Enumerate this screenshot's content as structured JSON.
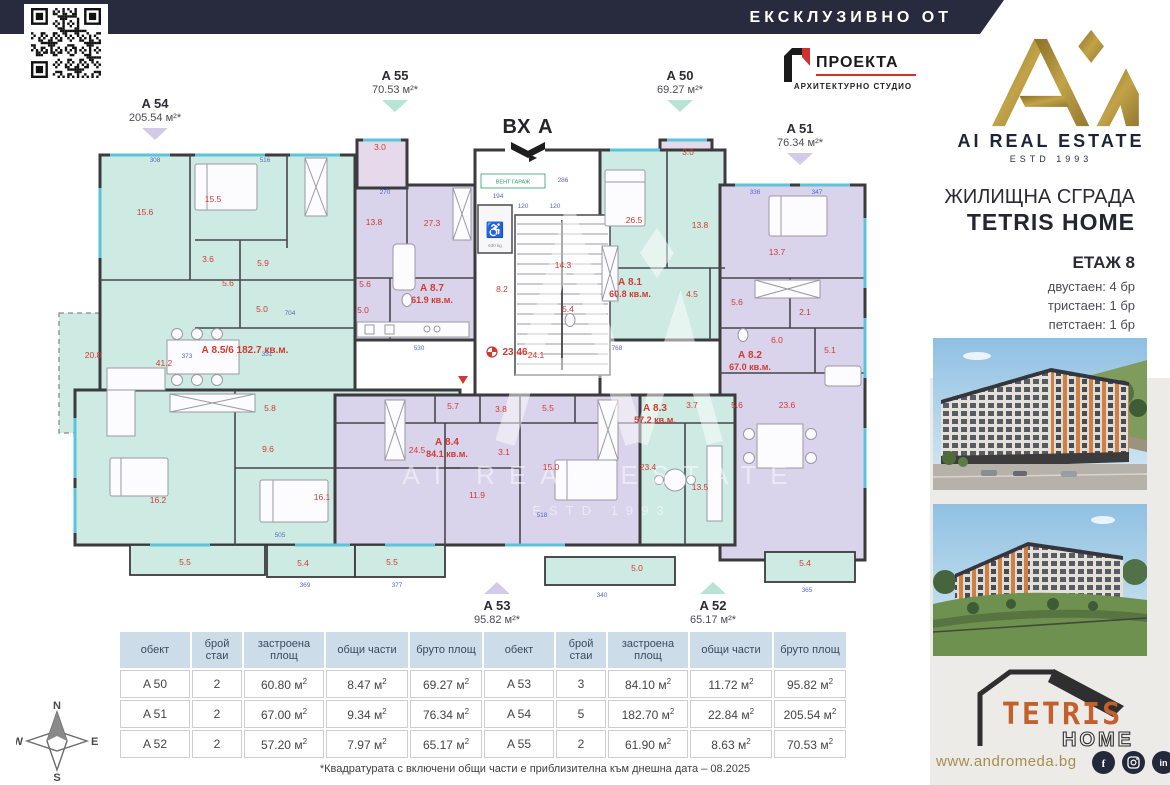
{
  "banner": {
    "label": "ЕКСКЛУЗИВНО ОТ"
  },
  "brand": {
    "name": "AI REAL ESTATE",
    "estd": "ESTD 1993"
  },
  "architect": {
    "name": "ПРОЕКТА",
    "subtitle": "АРХИТЕКТУРНО СТУДИО"
  },
  "building": {
    "type_label": "ЖИЛИЩНА СГРАДА",
    "name": "TETRIS HOME",
    "floor": "ЕТАЖ 8",
    "units": [
      "двустаен: 4 бр",
      "тристаен: 1 бр",
      "петстаен: 1 бр"
    ]
  },
  "entrance": {
    "label": "ВХ А"
  },
  "plan": {
    "callouts": [
      {
        "id": "A 54",
        "area": "205.54 м²*",
        "x": 155,
        "y": 96,
        "dir": "down",
        "tone": "lavender"
      },
      {
        "id": "A 55",
        "area": "70.53 м²*",
        "x": 395,
        "y": 68,
        "dir": "down",
        "tone": "mint"
      },
      {
        "id": "A 50",
        "area": "69.27 м²*",
        "x": 680,
        "y": 68,
        "dir": "down",
        "tone": "mint"
      },
      {
        "id": "A 51",
        "area": "76.34 м²*",
        "x": 800,
        "y": 121,
        "dir": "down",
        "tone": "lavender"
      },
      {
        "id": "A 53",
        "area": "95.82 м²*",
        "x": 497,
        "y": 582,
        "dir": "up",
        "tone": "lavender"
      },
      {
        "id": "A 52",
        "area": "65.17 м²*",
        "x": 713,
        "y": 582,
        "dir": "up",
        "tone": "mint"
      }
    ],
    "units": [
      {
        "id": "А 8.7",
        "area": "61.9 кв.м.",
        "x": 377,
        "y": 163
      },
      {
        "id": "А 8.1",
        "area": "60.8 кв.м.",
        "x": 575,
        "y": 157
      },
      {
        "id": "А 8.5/6",
        "area": "182.7 кв.м.",
        "x": 190,
        "y": 225,
        "inline": true
      },
      {
        "id": "А 8.2",
        "area": "67.0 кв.м.",
        "x": 695,
        "y": 230
      },
      {
        "id": "А 8.3",
        "area": "57.2 кв.м.",
        "x": 600,
        "y": 283
      },
      {
        "id": "А 8.4",
        "area": "84.1 кв.м.",
        "x": 392,
        "y": 317
      }
    ],
    "rooms": [
      {
        "t": "15.6",
        "x": 90,
        "y": 87
      },
      {
        "t": "15.5",
        "x": 158,
        "y": 74
      },
      {
        "t": "3.6",
        "x": 153,
        "y": 134
      },
      {
        "t": "5.9",
        "x": 208,
        "y": 138
      },
      {
        "t": "5.6",
        "x": 173,
        "y": 158
      },
      {
        "t": "5.0",
        "x": 207,
        "y": 184
      },
      {
        "t": "20.8",
        "x": 38,
        "y": 230
      },
      {
        "t": "41.2",
        "x": 109,
        "y": 238
      },
      {
        "t": "5.8",
        "x": 215,
        "y": 283
      },
      {
        "t": "9.6",
        "x": 213,
        "y": 324
      },
      {
        "t": "16.2",
        "x": 103,
        "y": 375
      },
      {
        "t": "16.1",
        "x": 267,
        "y": 372
      },
      {
        "t": "13.8",
        "x": 319,
        "y": 97
      },
      {
        "t": "27.3",
        "x": 377,
        "y": 98
      },
      {
        "t": "5.6",
        "x": 310,
        "y": 159
      },
      {
        "t": "5.0",
        "x": 308,
        "y": 185
      },
      {
        "t": "3.0",
        "x": 325,
        "y": 22
      },
      {
        "t": "3.0",
        "x": 633,
        "y": 27
      },
      {
        "t": "8.2",
        "x": 447,
        "y": 164
      },
      {
        "t": "14.3",
        "x": 508,
        "y": 140
      },
      {
        "t": "5.4",
        "x": 513,
        "y": 184
      },
      {
        "t": "24.1",
        "x": 481,
        "y": 230
      },
      {
        "t": "26.5",
        "x": 579,
        "y": 95
      },
      {
        "t": "13.8",
        "x": 645,
        "y": 100
      },
      {
        "t": "4.5",
        "x": 637,
        "y": 169
      },
      {
        "t": "5.6",
        "x": 682,
        "y": 177
      },
      {
        "t": "13.7",
        "x": 722,
        "y": 127
      },
      {
        "t": "2.1",
        "x": 750,
        "y": 187
      },
      {
        "t": "6.0",
        "x": 722,
        "y": 215
      },
      {
        "t": "5.1",
        "x": 775,
        "y": 225
      },
      {
        "t": "3.7",
        "x": 637,
        "y": 280
      },
      {
        "t": "5.6",
        "x": 682,
        "y": 280
      },
      {
        "t": "23.6",
        "x": 732,
        "y": 280
      },
      {
        "t": "23.4",
        "x": 593,
        "y": 342
      },
      {
        "t": "13.5",
        "x": 645,
        "y": 362
      },
      {
        "t": "5.7",
        "x": 398,
        "y": 281
      },
      {
        "t": "3.8",
        "x": 446,
        "y": 284
      },
      {
        "t": "5.5",
        "x": 493,
        "y": 283
      },
      {
        "t": "3.1",
        "x": 449,
        "y": 327
      },
      {
        "t": "24.5",
        "x": 362,
        "y": 325
      },
      {
        "t": "11.9",
        "x": 422,
        "y": 370
      },
      {
        "t": "15.0",
        "x": 496,
        "y": 342
      },
      {
        "t": "5.5",
        "x": 130,
        "y": 437
      },
      {
        "t": "5.4",
        "x": 248,
        "y": 438
      },
      {
        "t": "5.5",
        "x": 337,
        "y": 437
      },
      {
        "t": "5.0",
        "x": 582,
        "y": 443
      },
      {
        "t": "5.4",
        "x": 750,
        "y": 438
      }
    ],
    "dims": [
      {
        "t": "530",
        "x": 364,
        "y": 222
      },
      {
        "t": "768",
        "x": 562,
        "y": 222
      },
      {
        "t": "704",
        "x": 235,
        "y": 187
      },
      {
        "t": "373",
        "x": 132,
        "y": 230
      },
      {
        "t": "331",
        "x": 212,
        "y": 228
      },
      {
        "t": "286",
        "x": 508,
        "y": 54
      },
      {
        "t": "194",
        "x": 443,
        "y": 70
      },
      {
        "t": "120",
        "x": 468,
        "y": 80
      },
      {
        "t": "120",
        "x": 500,
        "y": 80
      },
      {
        "t": "377",
        "x": 342,
        "y": 459
      },
      {
        "t": "369",
        "x": 250,
        "y": 459
      },
      {
        "t": "340",
        "x": 547,
        "y": 469
      },
      {
        "t": "365",
        "x": 752,
        "y": 464
      },
      {
        "t": "505",
        "x": 225,
        "y": 409
      },
      {
        "t": "518",
        "x": 487,
        "y": 389
      },
      {
        "t": "308",
        "x": 100,
        "y": 34
      },
      {
        "t": "516",
        "x": 210,
        "y": 34
      },
      {
        "t": "336",
        "x": 700,
        "y": 66
      },
      {
        "t": "347",
        "x": 762,
        "y": 66
      },
      {
        "t": "270",
        "x": 330,
        "y": 66
      }
    ],
    "marks": {
      "total": "23.46",
      "vent": "ВЕНТ ГАРАЖ",
      "lift": "630 kg"
    }
  },
  "area_tables": {
    "headers": [
      "обект",
      "брой стаи",
      "застроена площ",
      "общи части",
      "бруто площ"
    ],
    "tables": [
      [
        [
          "A 50",
          "2",
          "60.80",
          "8.47",
          "69.27"
        ],
        [
          "A 51",
          "2",
          "67.00",
          "9.34",
          "76.34"
        ],
        [
          "A 52",
          "2",
          "57.20",
          "7.97",
          "65.17"
        ]
      ],
      [
        [
          "A 53",
          "3",
          "84.10",
          "11.72",
          "95.82"
        ],
        [
          "A 54",
          "5",
          "182.70",
          "22.84",
          "205.54"
        ],
        [
          "A 55",
          "2",
          "61.90",
          "8.63",
          "70.53"
        ]
      ]
    ]
  },
  "footnote": "*Квадратурата с включени общи части е приблизителна към днешна дата – 08.2025",
  "footer": {
    "website": "www.andromeda.bg",
    "social": [
      "facebook",
      "instagram",
      "linkedin"
    ],
    "logo_line1": "TETRIS",
    "logo_line2": "HOME"
  },
  "compass": {
    "n": "N",
    "e": "E",
    "s": "S",
    "w": "W"
  },
  "colors": {
    "banner": "#272b3d",
    "gold": "#a98c3f",
    "mint": "#cdebe2",
    "lavender": "#d9d3eb",
    "pink": "#e6d9ec",
    "red": "#d23a32",
    "dim_blue": "#5a68c4",
    "table_header": "#ccdce9",
    "wall": "#3b3b3d"
  }
}
